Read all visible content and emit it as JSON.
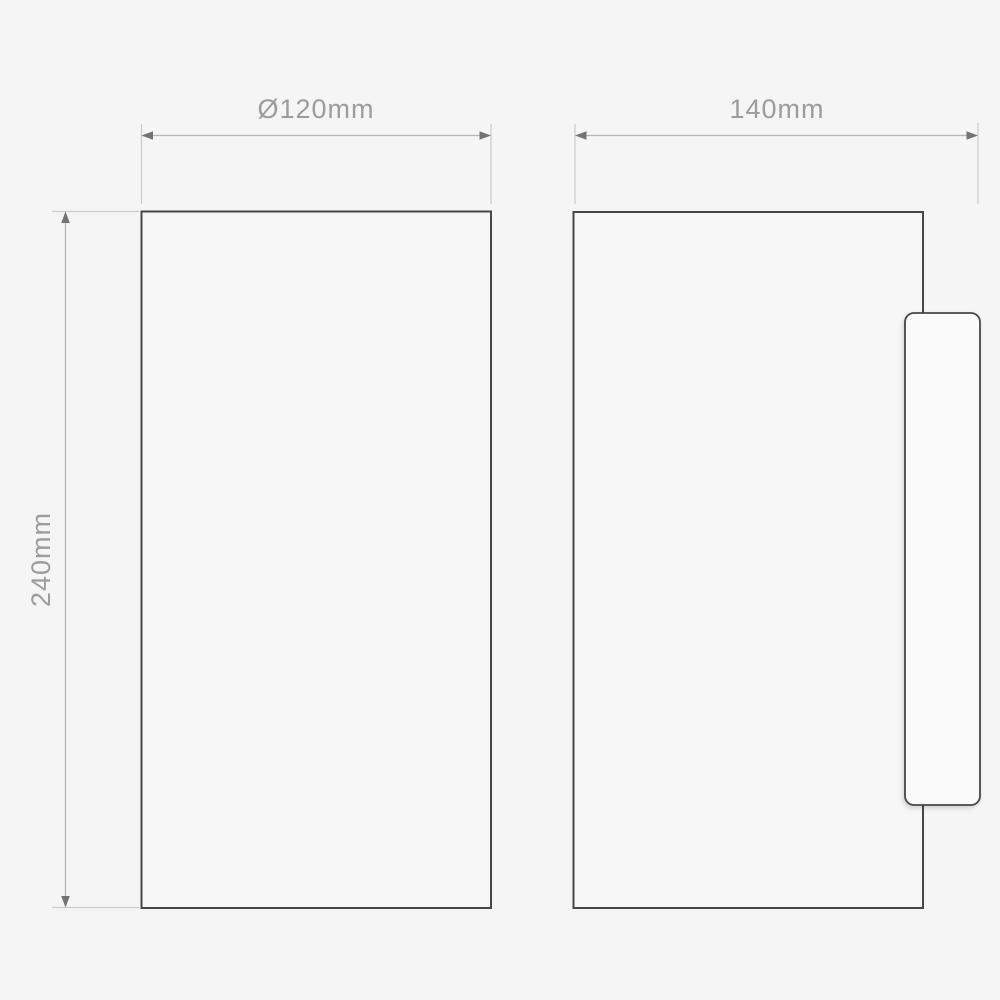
{
  "drawing": {
    "type": "technical-dimension-diagram",
    "views": [
      {
        "name": "front-view",
        "width_label": "Ø120mm",
        "width_mm": 120,
        "height_label": "240mm",
        "height_mm": 240
      },
      {
        "name": "side-view",
        "width_label": "140mm",
        "width_mm": 140
      }
    ],
    "colors": {
      "background": "#f5f5f6",
      "view_fill": "#f7f7f8",
      "outline": "#44474b",
      "plate_fill": "#fafafa",
      "dimension_line": "#b4b5b7",
      "extension_line": "#c9cacc",
      "arrow": "#717376",
      "label_text": "#9b9c9e"
    }
  }
}
